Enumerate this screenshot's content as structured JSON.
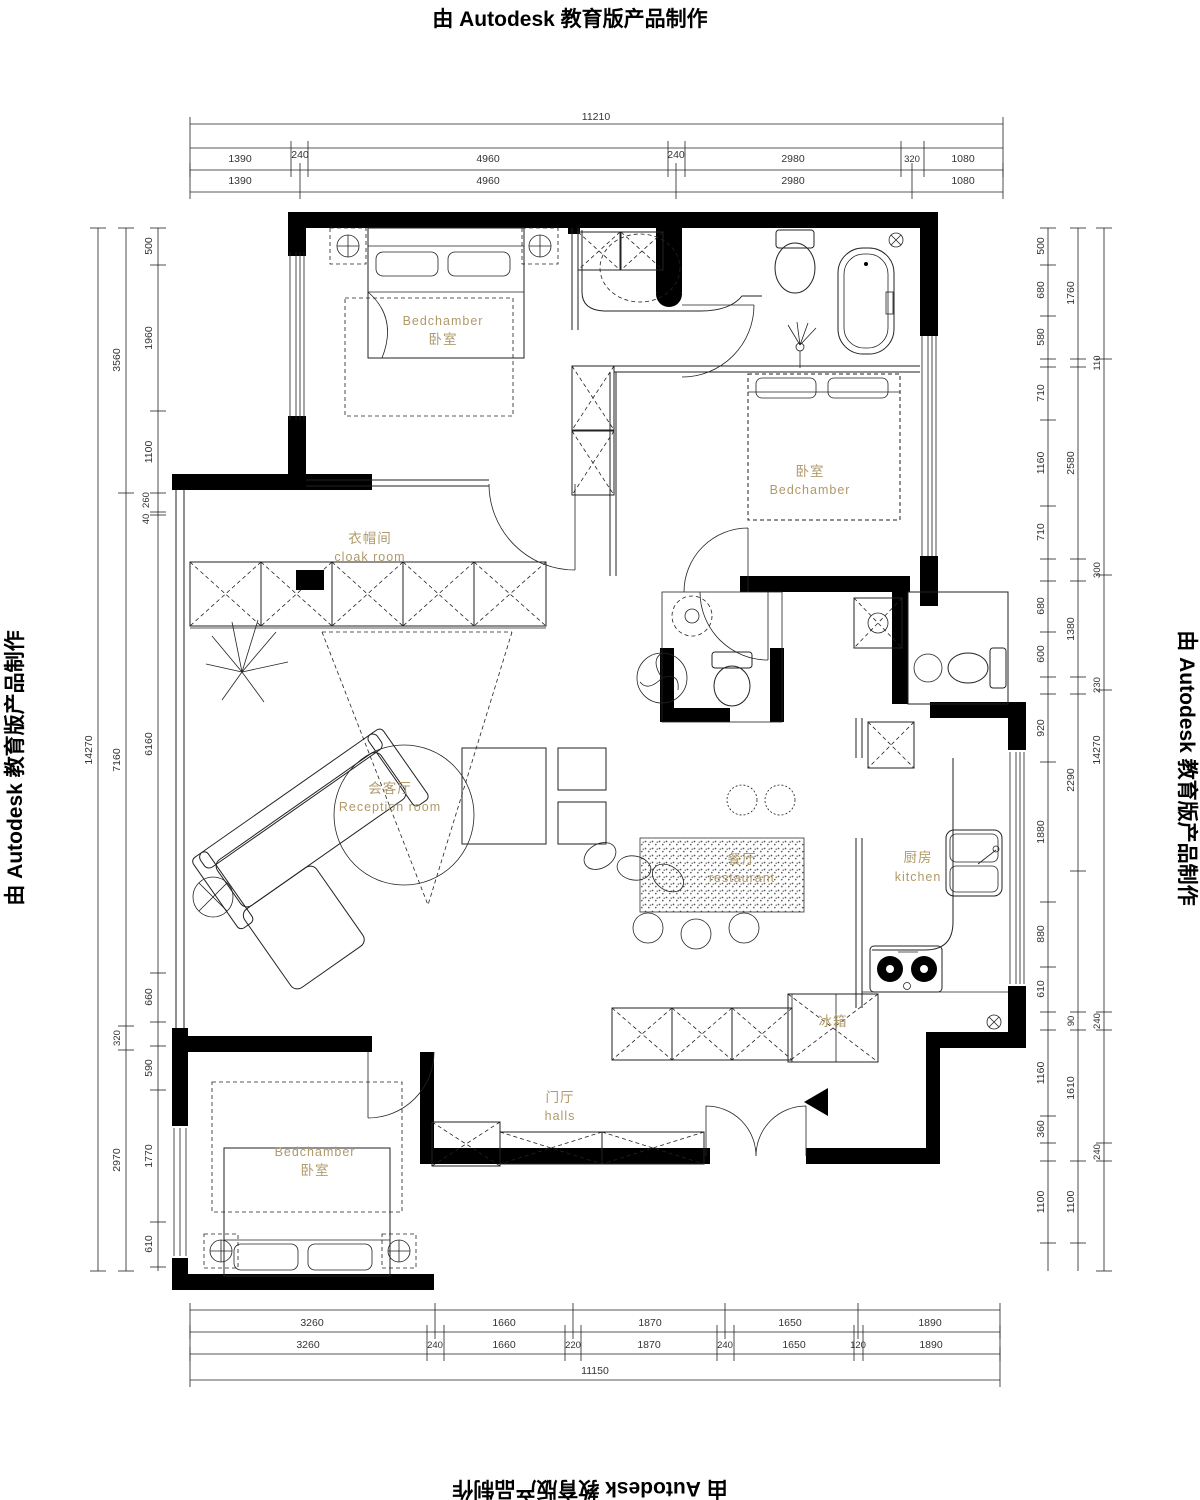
{
  "banner": {
    "text": "由 Autodesk 教育版产品制作"
  },
  "colors": {
    "label": "#b09a6a",
    "line": "#222222",
    "wall": "#000000"
  },
  "rooms": {
    "bedroom_top_left": {
      "en": "Bedchamber",
      "zh": "卧室"
    },
    "bedroom_right": {
      "zh": "卧室",
      "en": "Bedchamber"
    },
    "cloak_room": {
      "zh": "衣帽间",
      "en": "cloak room"
    },
    "reception_room": {
      "zh": "会客厅",
      "en": "Reception room"
    },
    "dining_room": {
      "zh": "餐厅",
      "en": "restaurant"
    },
    "kitchen": {
      "zh": "厨房",
      "en": "kitchen"
    },
    "hall": {
      "zh": "门厅",
      "en": "halls"
    },
    "bedroom_bottom_left": {
      "en": "Bedchamber",
      "zh": "卧室"
    },
    "fridge": {
      "zh": "冰箱"
    }
  },
  "dims": {
    "top": {
      "overall": "11210",
      "row1": [
        "1390",
        "240",
        "4960",
        "240",
        "2980",
        "320",
        "1080"
      ],
      "row2": [
        "1390",
        "4960",
        "2980",
        "1080"
      ]
    },
    "bottom": {
      "row1": [
        "3260",
        "1660",
        "1870",
        "1650",
        "1890"
      ],
      "row2": [
        "3260",
        "240",
        "1660",
        "220",
        "1870",
        "240",
        "1650",
        "120",
        "1890"
      ],
      "overall": "11150"
    },
    "left": {
      "overall": "14270",
      "mid": [
        "3560",
        "7160",
        "320",
        "2970"
      ],
      "inner": [
        "500",
        "1960",
        "1100",
        "260",
        "40",
        "6160",
        "660",
        "590",
        "1770",
        "610"
      ]
    },
    "right": {
      "overall": "14270",
      "mid": [
        "1760",
        "2580",
        "1380",
        "2290",
        "90",
        "1610",
        "1100"
      ],
      "inner": [
        "500",
        "680",
        "580",
        "710",
        "1160",
        "710",
        "680",
        "600",
        "920",
        "1880",
        "880",
        "610",
        "1160",
        "360",
        "1100"
      ],
      "outer": [
        "110",
        "300",
        "230",
        "240",
        "240"
      ]
    }
  }
}
